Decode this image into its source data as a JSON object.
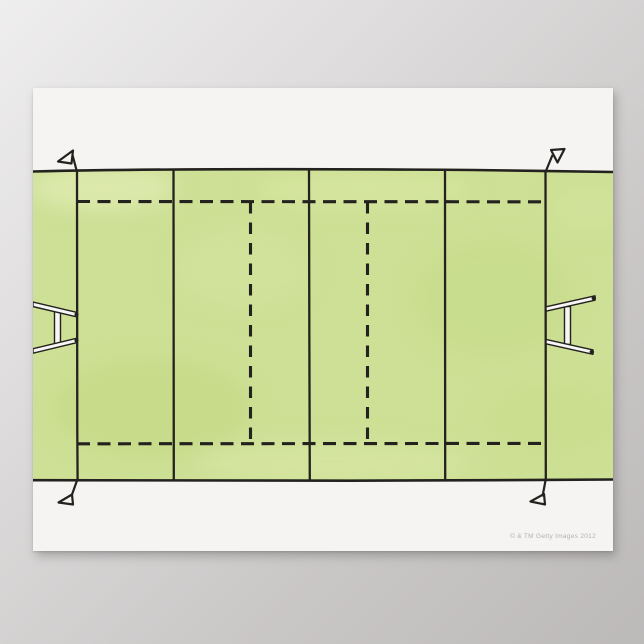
{
  "scene": {
    "type": "poster product mockup",
    "subject": "Illustration of a rugby pitch viewed from above"
  },
  "poster": {
    "watermark": "© & TM Getty Images 2012"
  },
  "colors": {
    "background_light": "#efeeee",
    "background_dark": "#bcb9b9",
    "paper": "#f5f4f2",
    "field_green": "#cde095",
    "line_ink": "#23221e",
    "post_white": "#f7f6f4",
    "watermark_gray": "#b4b1b1"
  },
  "field": {
    "elements": [
      "touchline-top",
      "touchline-bottom",
      "goal-line-left",
      "goal-line-right",
      "22m-line-left",
      "22m-line-right",
      "halfway-line",
      "10m-dashed-line-left",
      "10m-dashed-line-right",
      "5m-dashed-line-top",
      "5m-dashed-line-bottom",
      "goal-post-left",
      "goal-post-right",
      "corner-flag-top-left",
      "corner-flag-top-right",
      "corner-flag-bottom-left",
      "corner-flag-bottom-right"
    ]
  }
}
